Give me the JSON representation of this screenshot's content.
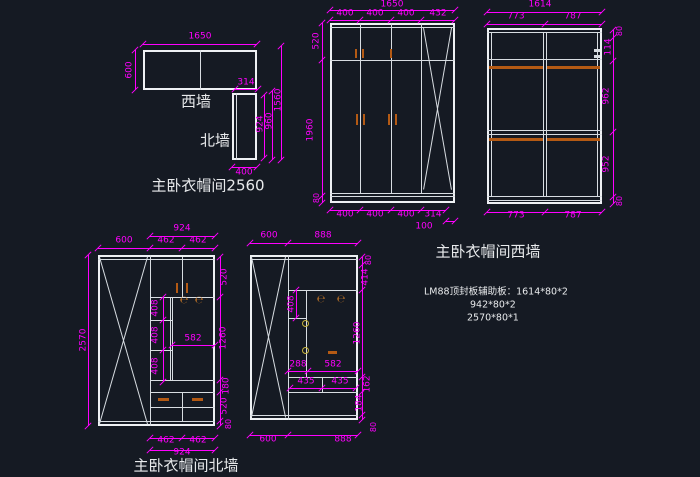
{
  "app": {
    "background_color": "#151a23",
    "dimension_color": "#ff00ff",
    "linework_color": "#d8dde2",
    "handle_color": "#b45a14"
  },
  "plan": {
    "title": "主卧衣帽间2560",
    "west_wall_label": "西墙",
    "north_wall_label": "北墙",
    "dims": {
      "top": "1650",
      "left": "600",
      "neck": "314",
      "inner_h": "924",
      "mid_h": "960",
      "total_h": "1560",
      "bottom": "400"
    }
  },
  "elev_center": {
    "dims": {
      "top_total": "1650",
      "top_cols": [
        "400",
        "400",
        "400",
        "432"
      ],
      "left": [
        "520",
        "1960",
        "80"
      ],
      "bottom_cols": [
        "400",
        "400",
        "400",
        "314"
      ],
      "bottom_offset": "100"
    }
  },
  "elev_west": {
    "title": "主卧衣帽间西墙",
    "dims": {
      "top_total": "1614",
      "top_cols": [
        "773",
        "787"
      ],
      "right": [
        "80",
        "114",
        "962",
        "952",
        "80"
      ],
      "bottom_cols": [
        "773",
        "787"
      ]
    }
  },
  "note": {
    "lines": [
      "LM88顶封板辅助板：1614*80*2",
      "942*80*2",
      "2570*80*1"
    ]
  },
  "elev_north_left": {
    "title": "主卧衣帽间北墙",
    "dims": {
      "top_span": "924",
      "top_cols": [
        "600",
        "462",
        "462"
      ],
      "left_total": "2570",
      "shelf_heights": [
        "408",
        "408",
        "408"
      ],
      "open_width": "582",
      "right": [
        "520",
        "1260",
        "180",
        "520",
        "80"
      ],
      "bottom_cols": [
        "462",
        "462"
      ],
      "bottom_span": "924"
    }
  },
  "elev_north_mid": {
    "dims": {
      "top_cols": [
        "600",
        "888"
      ],
      "shelf_height": "408",
      "col_width": "288",
      "open_width": "582",
      "drawer_cols": [
        "435",
        "435"
      ],
      "right": [
        "80",
        "414",
        "1260",
        "162",
        "184",
        "80"
      ],
      "bottom_cols": [
        "600",
        "888"
      ]
    }
  },
  "icons": {
    "hook": "℮"
  }
}
